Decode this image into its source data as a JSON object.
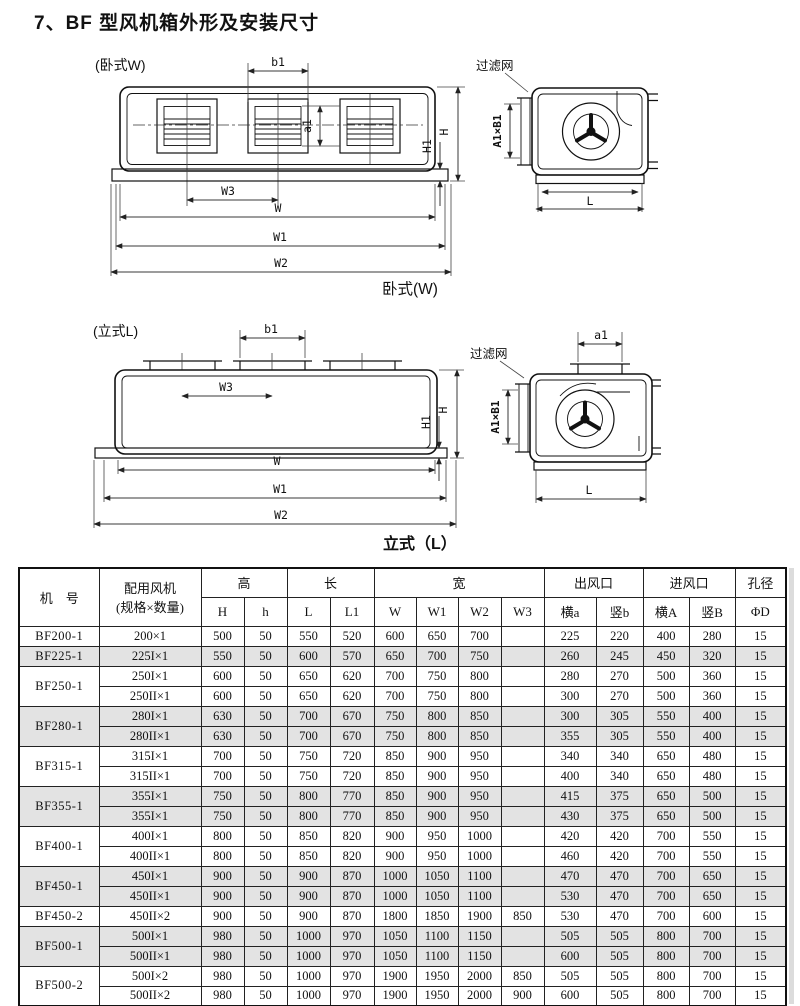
{
  "page": {
    "title": "7、BF 型风机箱外形及安装尺寸"
  },
  "diagram_w": {
    "label": "(卧式W)",
    "caption": "卧式(W)",
    "filter": "过滤网",
    "dims": {
      "b1": "b1",
      "a1": "a1",
      "H1": "H1",
      "H": "H",
      "W3": "W3",
      "W": "W",
      "W1": "W1",
      "W2": "W2",
      "L": "L",
      "AB": "A1×B1"
    }
  },
  "diagram_l": {
    "label": "(立式L)",
    "caption": "立式（L）",
    "filter": "过滤网",
    "dims": {
      "b1": "b1",
      "a1": "a1",
      "H1": "H1",
      "H": "H",
      "W3": "W3",
      "W": "W",
      "W1": "W1",
      "W2": "W2",
      "L": "L",
      "AB": "A1×B1"
    }
  },
  "table": {
    "header": {
      "col_model": "机　号",
      "col_fan_line1": "配用风机",
      "col_fan_line2": "(规格×数量)",
      "grp_height": "高",
      "grp_length": "长",
      "grp_width": "宽",
      "grp_outlet": "出风口",
      "grp_inlet": "进风口",
      "grp_hole": "孔径",
      "sub": [
        "H",
        "h",
        "L",
        "L1",
        "W",
        "W1",
        "W2",
        "W3",
        "横a",
        "竖b",
        "横A",
        "竖B",
        "ΦD"
      ]
    },
    "groups": [
      {
        "model": "BF200-1",
        "shaded": false,
        "rows": [
          {
            "spec": "200×1",
            "values": [
              "500",
              "50",
              "550",
              "520",
              "600",
              "650",
              "700",
              "",
              "225",
              "220",
              "400",
              "280",
              "15"
            ]
          }
        ]
      },
      {
        "model": "BF225-1",
        "shaded": true,
        "rows": [
          {
            "spec": "225I×1",
            "values": [
              "550",
              "50",
              "600",
              "570",
              "650",
              "700",
              "750",
              "",
              "260",
              "245",
              "450",
              "320",
              "15"
            ]
          }
        ]
      },
      {
        "model": "BF250-1",
        "shaded": false,
        "rows": [
          {
            "spec": "250I×1",
            "values": [
              "600",
              "50",
              "650",
              "620",
              "700",
              "750",
              "800",
              "",
              "280",
              "270",
              "500",
              "360",
              "15"
            ]
          },
          {
            "spec": "250II×1",
            "values": [
              "600",
              "50",
              "650",
              "620",
              "700",
              "750",
              "800",
              "",
              "300",
              "270",
              "500",
              "360",
              "15"
            ]
          }
        ]
      },
      {
        "model": "BF280-1",
        "shaded": true,
        "rows": [
          {
            "spec": "280I×1",
            "values": [
              "630",
              "50",
              "700",
              "670",
              "750",
              "800",
              "850",
              "",
              "300",
              "305",
              "550",
              "400",
              "15"
            ]
          },
          {
            "spec": "280II×1",
            "values": [
              "630",
              "50",
              "700",
              "670",
              "750",
              "800",
              "850",
              "",
              "355",
              "305",
              "550",
              "400",
              "15"
            ]
          }
        ]
      },
      {
        "model": "BF315-1",
        "shaded": false,
        "rows": [
          {
            "spec": "315I×1",
            "values": [
              "700",
              "50",
              "750",
              "720",
              "850",
              "900",
              "950",
              "",
              "340",
              "340",
              "650",
              "480",
              "15"
            ]
          },
          {
            "spec": "315II×1",
            "values": [
              "700",
              "50",
              "750",
              "720",
              "850",
              "900",
              "950",
              "",
              "400",
              "340",
              "650",
              "480",
              "15"
            ]
          }
        ]
      },
      {
        "model": "BF355-1",
        "shaded": true,
        "rows": [
          {
            "spec": "355I×1",
            "values": [
              "750",
              "50",
              "800",
              "770",
              "850",
              "900",
              "950",
              "",
              "415",
              "375",
              "650",
              "500",
              "15"
            ]
          },
          {
            "spec": "355I×1",
            "values": [
              "750",
              "50",
              "800",
              "770",
              "850",
              "900",
              "950",
              "",
              "430",
              "375",
              "650",
              "500",
              "15"
            ]
          }
        ]
      },
      {
        "model": "BF400-1",
        "shaded": false,
        "rows": [
          {
            "spec": "400I×1",
            "values": [
              "800",
              "50",
              "850",
              "820",
              "900",
              "950",
              "1000",
              "",
              "420",
              "420",
              "700",
              "550",
              "15"
            ]
          },
          {
            "spec": "400II×1",
            "values": [
              "800",
              "50",
              "850",
              "820",
              "900",
              "950",
              "1000",
              "",
              "460",
              "420",
              "700",
              "550",
              "15"
            ]
          }
        ]
      },
      {
        "model": "BF450-1",
        "shaded": true,
        "rows": [
          {
            "spec": "450I×1",
            "values": [
              "900",
              "50",
              "900",
              "870",
              "1000",
              "1050",
              "1100",
              "",
              "470",
              "470",
              "700",
              "650",
              "15"
            ]
          },
          {
            "spec": "450II×1",
            "values": [
              "900",
              "50",
              "900",
              "870",
              "1000",
              "1050",
              "1100",
              "",
              "530",
              "470",
              "700",
              "650",
              "15"
            ]
          }
        ]
      },
      {
        "model": "BF450-2",
        "shaded": false,
        "rows": [
          {
            "spec": "450II×2",
            "values": [
              "900",
              "50",
              "900",
              "870",
              "1800",
              "1850",
              "1900",
              "850",
              "530",
              "470",
              "700",
              "600",
              "15"
            ]
          }
        ]
      },
      {
        "model": "BF500-1",
        "shaded": true,
        "rows": [
          {
            "spec": "500I×1",
            "values": [
              "980",
              "50",
              "1000",
              "970",
              "1050",
              "1100",
              "1150",
              "",
              "505",
              "505",
              "800",
              "700",
              "15"
            ]
          },
          {
            "spec": "500II×1",
            "values": [
              "980",
              "50",
              "1000",
              "970",
              "1050",
              "1100",
              "1150",
              "",
              "600",
              "505",
              "800",
              "700",
              "15"
            ]
          }
        ]
      },
      {
        "model": "BF500-2",
        "shaded": false,
        "rows": [
          {
            "spec": "500I×2",
            "values": [
              "980",
              "50",
              "1000",
              "970",
              "1900",
              "1950",
              "2000",
              "850",
              "505",
              "505",
              "800",
              "700",
              "15"
            ]
          },
          {
            "spec": "500II×2",
            "values": [
              "980",
              "50",
              "1000",
              "970",
              "1900",
              "1950",
              "2000",
              "900",
              "600",
              "505",
              "800",
              "700",
              "15"
            ]
          }
        ]
      }
    ]
  }
}
